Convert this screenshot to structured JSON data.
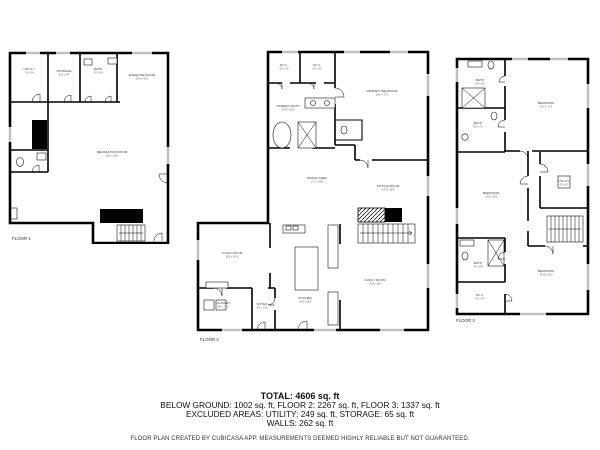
{
  "colors": {
    "wall": "#000000",
    "label_text": "#3d3d3d",
    "summary_text": "#111111",
    "background": "#ffffff"
  },
  "floors": [
    {
      "label": "FLOOR 1",
      "rooms": [
        {
          "name": "UTILITY",
          "dims": "7'6 x 9'4"
        },
        {
          "name": "STORAGE",
          "dims": "6'10 x 9'4"
        },
        {
          "name": "BATH",
          "dims": "7'6 x 9'4"
        },
        {
          "name": "EXERCISE ROOM",
          "dims": "15'6 x 9'10"
        },
        {
          "name": "RECREATION ROOM",
          "dims": "32'6 x 23'5"
        }
      ]
    },
    {
      "label": "FLOOR 2",
      "rooms": [
        {
          "name": "W.I.C.",
          "dims": "5'6 x 6'5"
        },
        {
          "name": "W.I.C.",
          "dims": "6'1 x 6'5"
        },
        {
          "name": "PRIMARY BEDROOM",
          "dims": "18'5 x 17'2"
        },
        {
          "name": "PRIMARY BATH",
          "dims": "12'4 x 11'6"
        },
        {
          "name": "DINING AREA",
          "dims": "17'7 x 20'0"
        },
        {
          "name": "SITTING ROOM",
          "dims": "14'2 x 15'8"
        },
        {
          "name": "LIVING ROOM",
          "dims": "13'6 x 14'10"
        },
        {
          "name": "KITCHEN",
          "dims": "13'9 x 16'4"
        },
        {
          "name": "FAMILY ROOM",
          "dims": "16'8 x 18'2"
        },
        {
          "name": "LAUNDRY",
          "dims": "9'6 x 7'10"
        },
        {
          "name": "FOYER",
          "dims": "6'2 x 7'10"
        }
      ]
    },
    {
      "label": "FLOOR 3",
      "rooms": [
        {
          "name": "BATH",
          "dims": "8'0 x 6'1"
        },
        {
          "name": "BEDROOM",
          "dims": "15'2 x 17'4"
        },
        {
          "name": "BATH",
          "dims": "8'0 x 7'2"
        },
        {
          "name": "BEDROOM",
          "dims": "13'5 x 12'6"
        },
        {
          "name": "UTILITY",
          "dims": "8'2 x 8'7"
        },
        {
          "name": "BATH",
          "dims": "6'5 x 8'4"
        },
        {
          "name": "W.I.C.",
          "dims": "8'0 x 5'4"
        },
        {
          "name": "BEDROOM",
          "dims": "14'10 x 12'8"
        }
      ]
    }
  ],
  "summary": {
    "total": "TOTAL: 4606 sq. ft",
    "by_floor": "BELOW GROUND: 1002 sq. ft, FLOOR 2: 2267 sq. ft, FLOOR 3: 1337 sq. ft",
    "excluded": "EXCLUDED AREAS: UTILITY: 249 sq. ft, STORAGE: 65 sq. ft",
    "walls": "WALLS: 262 sq. ft",
    "disclaimer": "FLOOR PLAN CREATED BY CUBICASA APP. MEASUREMENTS DEEMED HIGHLY RELIABLE BUT NOT GUARANTEED."
  }
}
